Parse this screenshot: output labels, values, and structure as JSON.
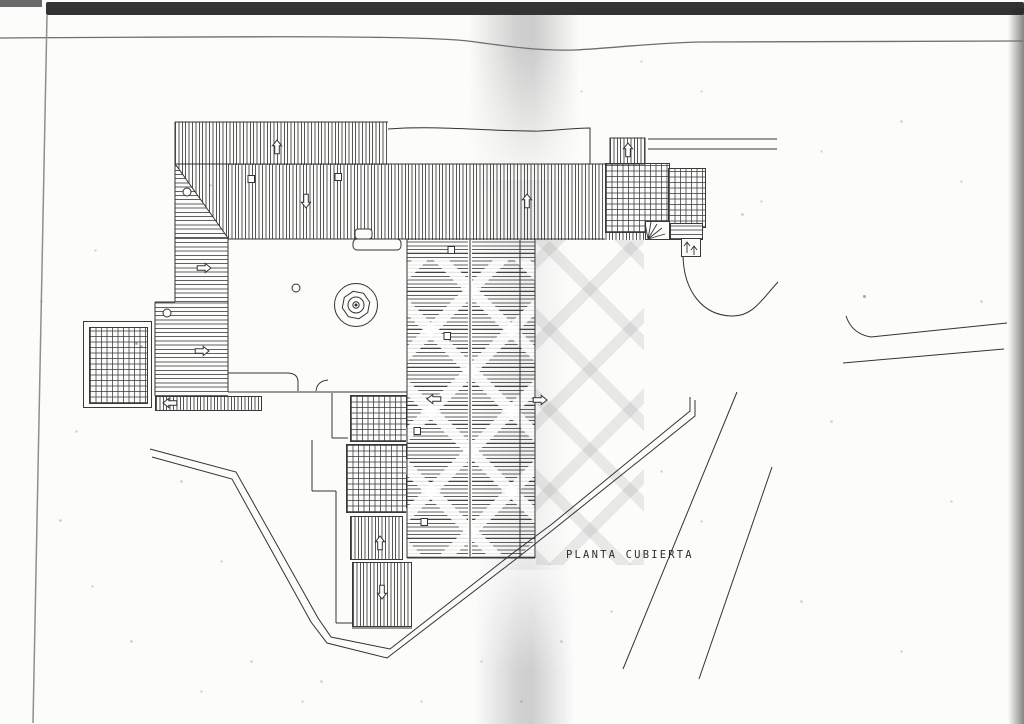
{
  "document": {
    "caption": "PLANTA CUBIERTA"
  },
  "palette": {
    "ink": "#333333",
    "paper": "#fcfcfb",
    "scanner_band": "#242424",
    "fold_shadow": "#cbcbc9"
  }
}
